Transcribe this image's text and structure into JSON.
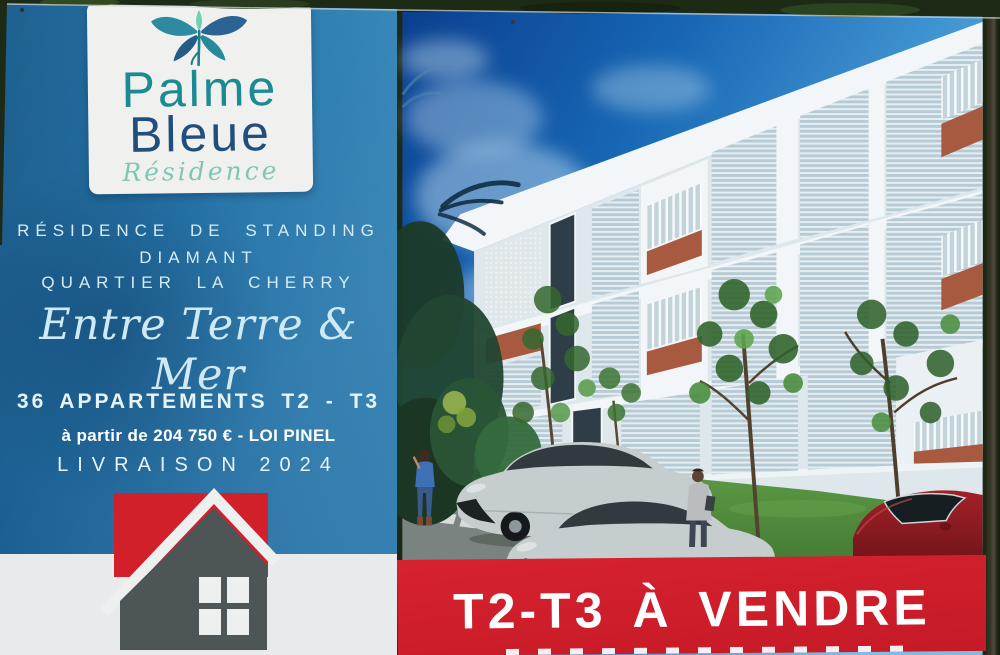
{
  "sign": {
    "logo_card": {
      "brand_top": "Palme",
      "brand_bottom": "Bleue",
      "brand_sub": "Résidence"
    },
    "panel": {
      "line1": "RÉSIDENCE DE STANDING",
      "line2": "DIAMANT",
      "line3": "QUARTIER LA CHERRY",
      "tagline": "Entre Terre & Mer",
      "units": "36 APPARTEMENTS T2 - T3",
      "price": "à partir de 204 750 € - LOI PINEL",
      "delivery": "LIVRAISON 2024"
    },
    "banner": {
      "title": "T2-T3 À VENDRE"
    }
  },
  "icons": {
    "palm": "palm-leaves-icon",
    "house": "house-icon"
  },
  "colors": {
    "panel_blue": "#2271a6",
    "banner_red": "#d2202b",
    "logo_teal": "#1b8a93",
    "logo_navy": "#214f7d",
    "script_teal": "#7fc6b4",
    "accent_terracotta": "#a85a41"
  }
}
